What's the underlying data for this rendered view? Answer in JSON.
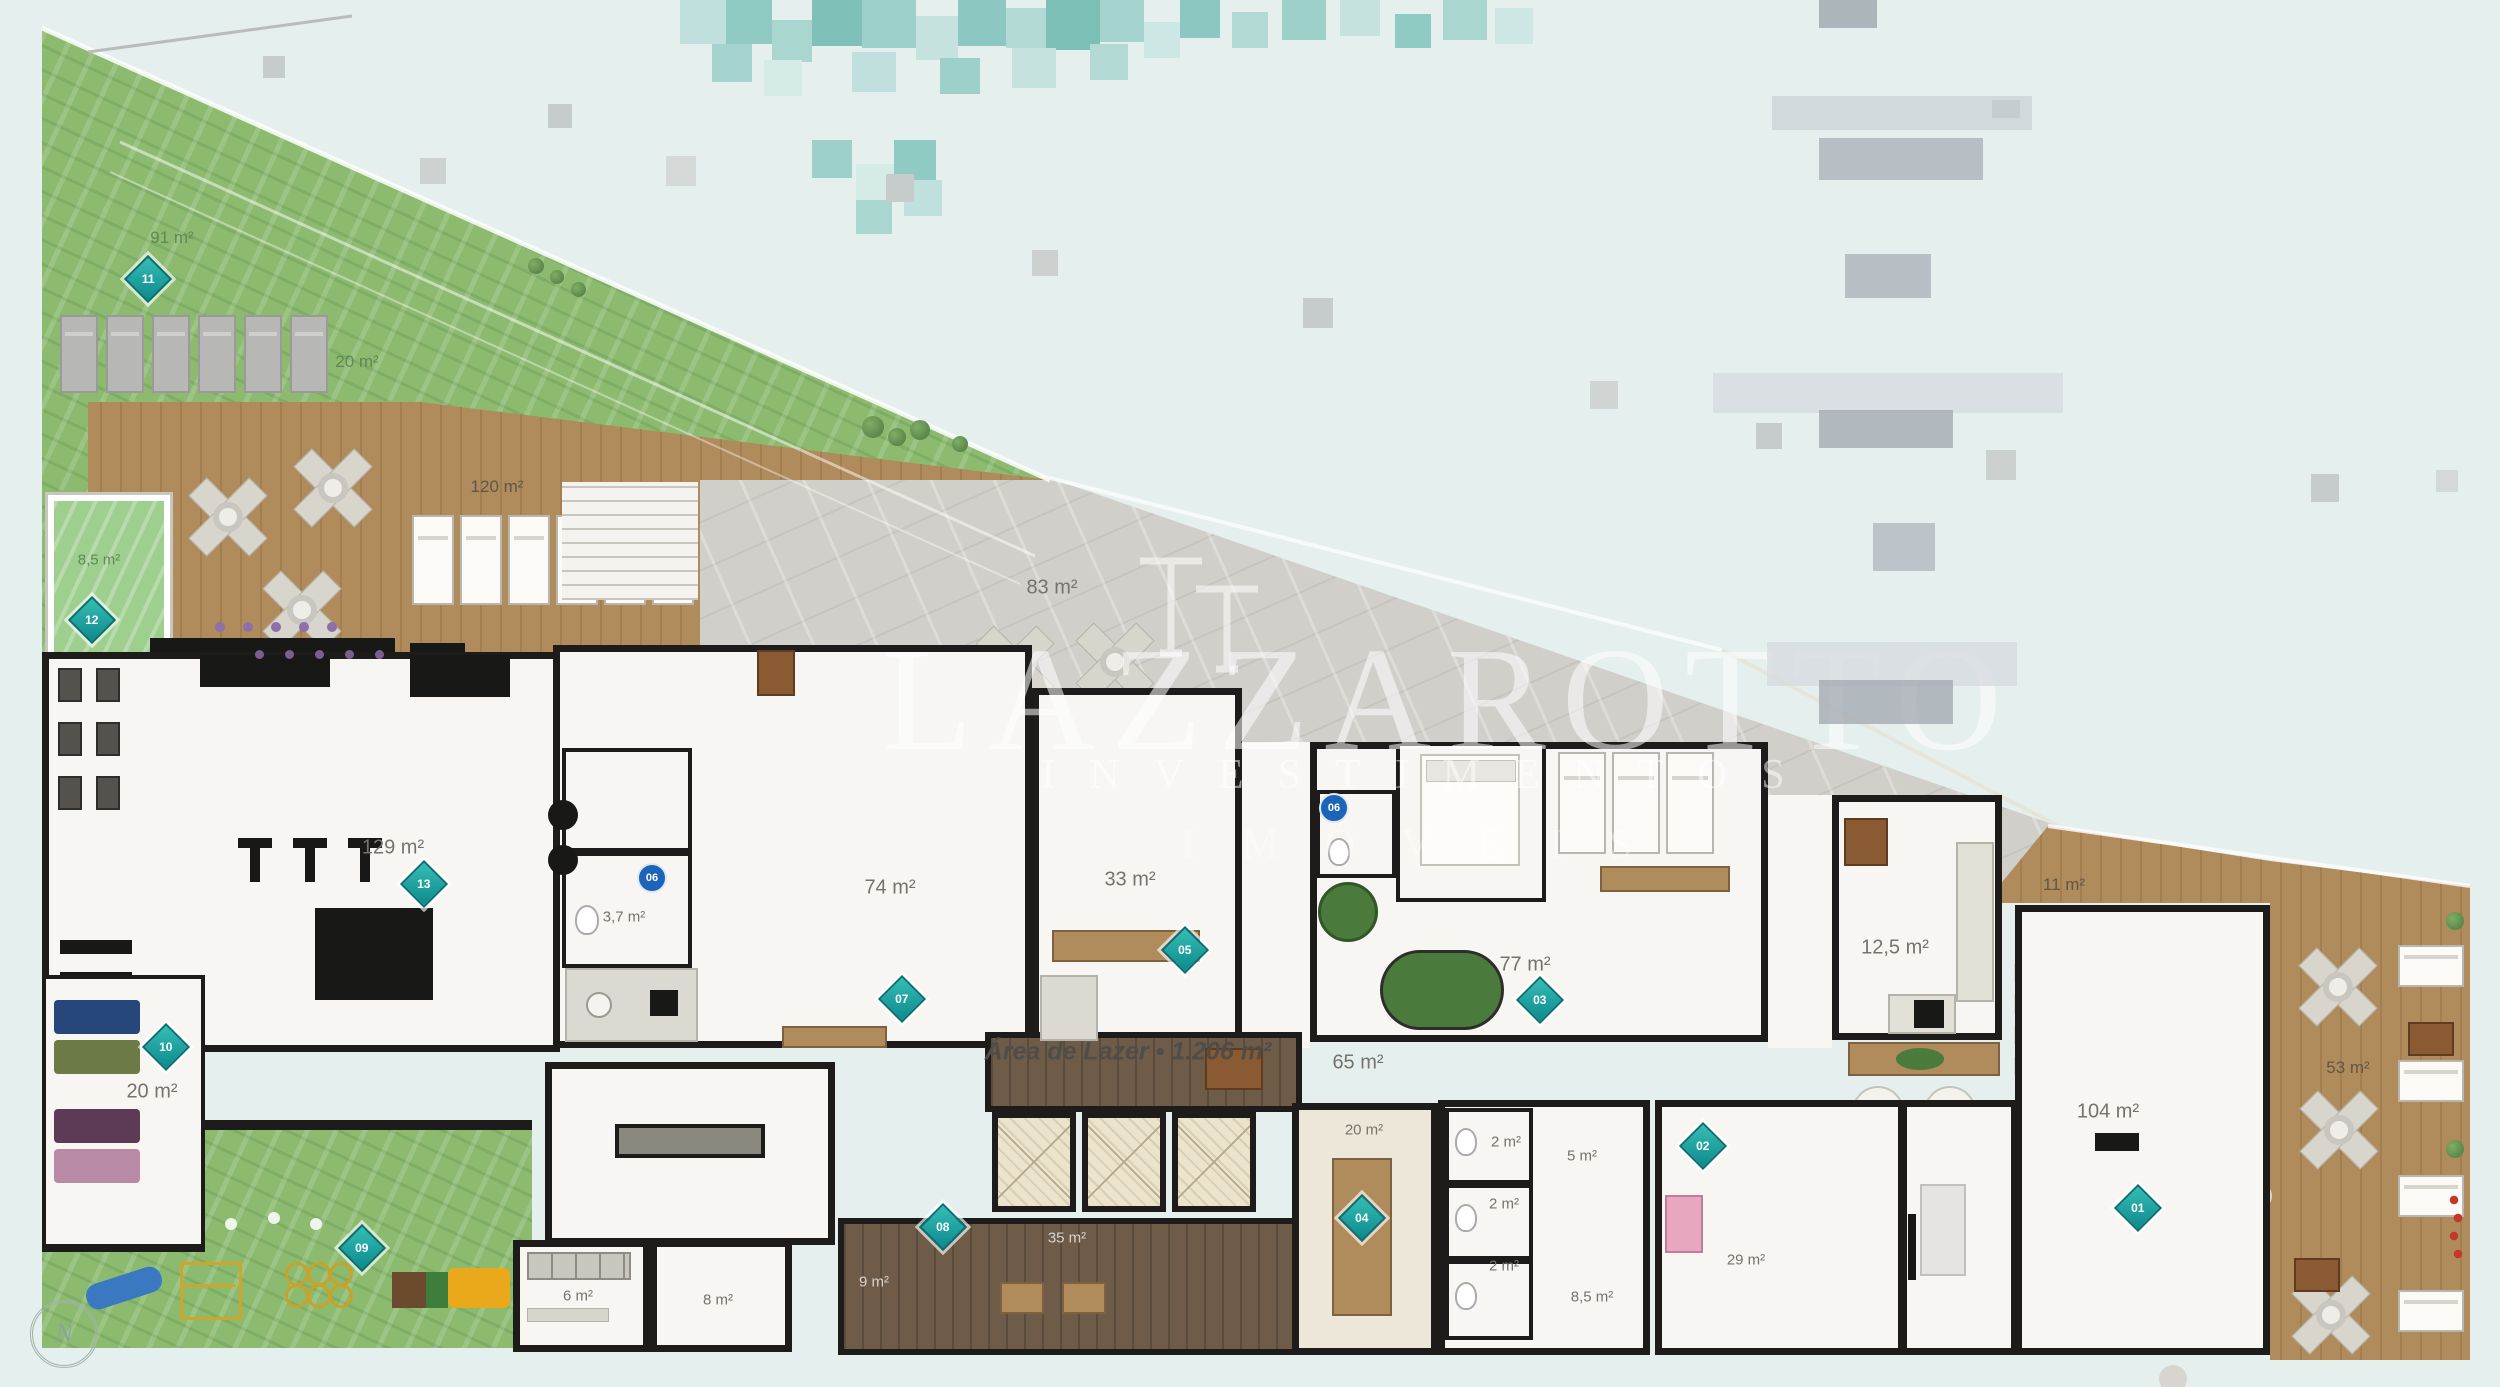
{
  "plan": {
    "title": "Área de Lazer • 1.206 m²",
    "compass": "N"
  },
  "watermark": {
    "brand": "LAZZAROTTO",
    "line2": "INVESTIMENTOS",
    "line3": "IMÓVEIS"
  },
  "rooms": {
    "lawn": {
      "area": "91 m²",
      "marker": "11"
    },
    "sun_lawn": {
      "area": "20 m²"
    },
    "deck": {
      "area": "120 m²"
    },
    "kids_pool": {
      "area": "8,5 m²",
      "marker": "12"
    },
    "terrace": {
      "area": "83 m²"
    },
    "gym": {
      "area": "129 m²",
      "marker": "13"
    },
    "yoga": {
      "area": "20 m²",
      "marker": "10"
    },
    "playground": {
      "marker": "09"
    },
    "wc_gym": {
      "area": "3,7 m²",
      "marker": "06"
    },
    "party_hall": {
      "area": "74 m²",
      "marker": "07"
    },
    "gourmet": {
      "area": "33 m²",
      "marker": "05"
    },
    "games": {
      "area": "77 m²",
      "marker": "03"
    },
    "wc_games": {
      "marker": "06"
    },
    "kitchen": {
      "area": "12,5 m²"
    },
    "deck_upper_right": {
      "area": "11 m²"
    },
    "banquet_hall": {
      "area": "104 m²",
      "marker": "01"
    },
    "deck_right": {
      "area": "53 m²"
    },
    "circulation": {
      "area": "65 m²"
    },
    "storage_6": {
      "area": "6 m²"
    },
    "storage_8": {
      "area": "8 m²"
    },
    "corridor_9": {
      "area": "9 m²"
    },
    "salon": {
      "area": "35 m²",
      "marker": "08"
    },
    "sauna": {
      "area": "20 m²",
      "marker": "04"
    },
    "wc_1": {
      "area": "2 m²"
    },
    "wc_2": {
      "area": "2 m²"
    },
    "wc_3": {
      "area": "2 m²"
    },
    "wc_5": {
      "area": "5 m²"
    },
    "shower": {
      "area": "8,5 m²"
    },
    "kids": {
      "area": "29 m²",
      "marker": "02"
    }
  }
}
